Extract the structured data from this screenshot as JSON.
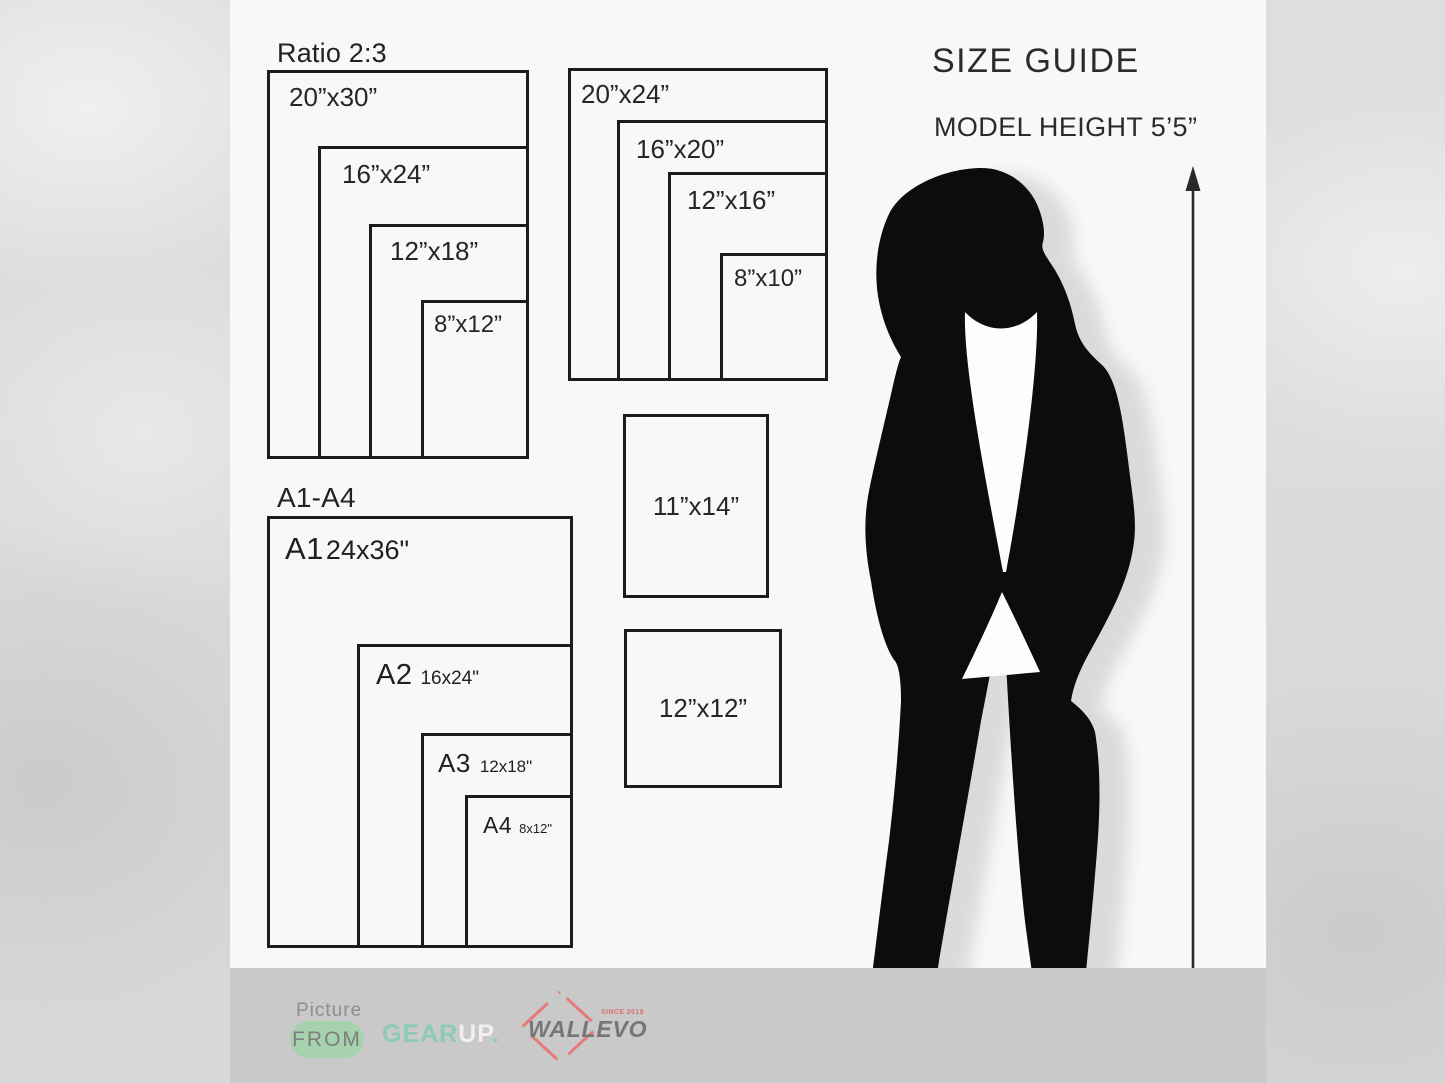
{
  "page": {
    "title": "SIZE GUIDE",
    "model_height": "MODEL HEIGHT 5’5”"
  },
  "groups": {
    "ratio23": {
      "label": "Ratio 2:3",
      "boxes": [
        {
          "label": "20”x30”"
        },
        {
          "label": "16”x24”"
        },
        {
          "label": "12”x18”"
        },
        {
          "label": "8”x12”"
        }
      ]
    },
    "standard": {
      "boxes": [
        {
          "label": "20”x24”"
        },
        {
          "label": "16”x20”"
        },
        {
          "label": "12”x16”"
        },
        {
          "label": "8”x10”"
        }
      ]
    },
    "singles": [
      {
        "label": "11”x14”"
      },
      {
        "label": "12”x12”"
      }
    ],
    "a_series": {
      "label": "A1-A4",
      "boxes": [
        {
          "code": "A1",
          "size": "24x36\""
        },
        {
          "code": "A2",
          "size": "16x24\""
        },
        {
          "code": "A3",
          "size": "12x18\""
        },
        {
          "code": "A4",
          "size": "8x12\""
        }
      ]
    }
  },
  "footer": {
    "picture": "Picture",
    "from": "FROM",
    "gear": "GEAR",
    "up": "UP",
    "dot": ".",
    "wallevo": "WALLEVO",
    "since": "SINCE 2019"
  },
  "colors": {
    "pill_green": "#a6d2ae",
    "gear_teal": "#8ccbb3",
    "up_white": "#f1f0ed",
    "wallevo_gray": "#767676",
    "diamond_red": "#e57b78",
    "footer_bar": "#c9c9ca",
    "panel_bg": "#f8f8f6"
  }
}
